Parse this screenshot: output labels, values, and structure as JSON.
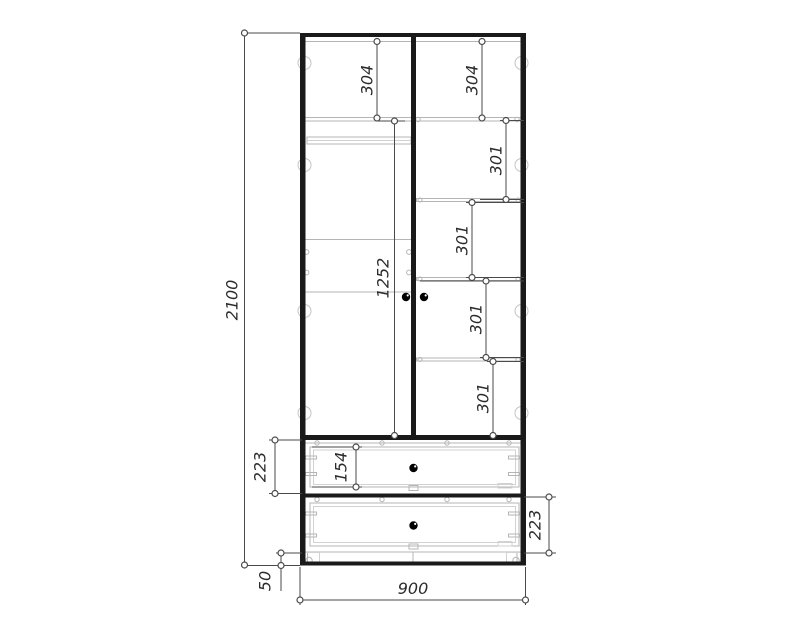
{
  "page": {
    "background": "#ffffff"
  },
  "drawing": {
    "type": "wardrobe-technical-drawing",
    "colors": {
      "structure": "#1a1a1a",
      "interior_detail": "#b5b5b5",
      "dimension_lines": "#4a4a4a",
      "dimension_text": "#2b2b2b",
      "knob": "#000000"
    },
    "dimensions": {
      "overall_height": "2100",
      "overall_width": "900",
      "plinth_height": "50",
      "left_top_section_height": "304",
      "right_top_section_height": "304",
      "right_shelf_spacing_1": "301",
      "right_shelf_spacing_2": "301",
      "right_shelf_spacing_3": "301",
      "right_shelf_spacing_4": "301",
      "left_hanging_height": "1252",
      "upper_drawer_section_height": "223",
      "drawer_front_height": "154",
      "lower_drawer_section_height": "223"
    }
  }
}
